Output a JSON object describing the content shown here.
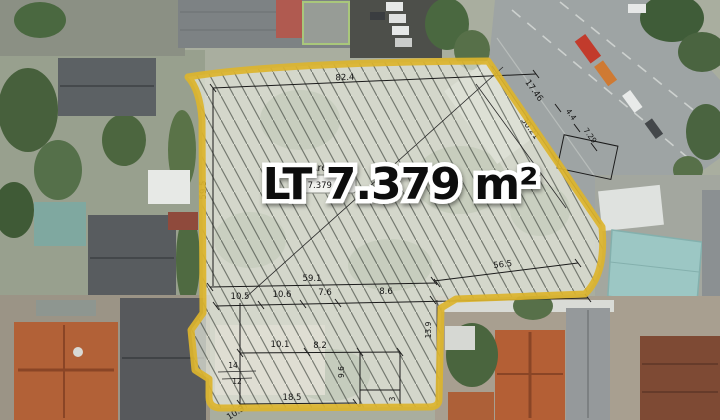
{
  "overlay": {
    "main_label": "LT 7.379 m²",
    "area_tag": {
      "label": "Area",
      "box_value": "7.379 m2"
    },
    "boundary_color": "#dcb42c",
    "dims": {
      "top": "82.4",
      "left": "59.5",
      "diag_a": "17.46",
      "diag_b": "4.4",
      "diag_c": "7.29",
      "diag_d": "30.21",
      "mid": "59.1",
      "row_1": "10.5",
      "row_2": "10.6",
      "row_3": "7.6",
      "row_4": "8.6",
      "lower_right": "56.5",
      "ext_1": "10.1",
      "ext_2": "8.2",
      "ext_3": "14",
      "ext_4": "12",
      "ext_bottom": "18.5",
      "ext_diag": "10.3",
      "ext_v1": "9.6",
      "ext_v2": "13.9",
      "ext_v3": "3"
    }
  }
}
